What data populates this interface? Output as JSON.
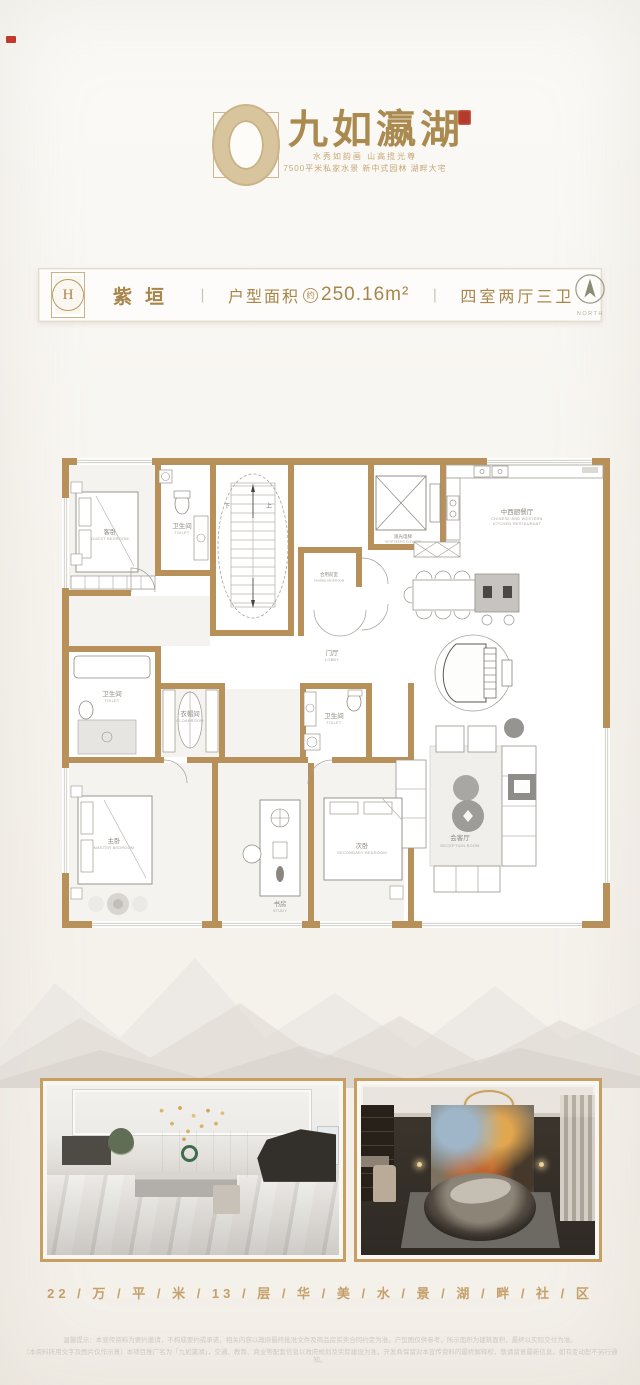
{
  "logo": {
    "brand_name": "九如瀛湖",
    "tagline_line1": "水秀如韵画 山高揽光尊",
    "tagline_line2": "7500平米私家水景 新中式园林 湖畔大宅"
  },
  "banner": {
    "emblem_letter": "H",
    "unit_name": "紫垣",
    "divider": "丨",
    "area_label": "户型面积",
    "area_circle": "约",
    "area_value": "250.16m²",
    "rooms_label": "四室两厅三卫",
    "compass_label": "NORTH"
  },
  "floorplan": {
    "stair_up": "上",
    "stair_down": "下",
    "rooms": {
      "guest_bedroom": {
        "cn": "客卧",
        "en": "GUEST BEDROOM"
      },
      "toilet_top": {
        "cn": "卫生间",
        "en": "TOILET"
      },
      "shared_anteroom": {
        "cn": "合用前室",
        "en": "SHARED ANTEROOM"
      },
      "elevator": {
        "cn": "观光电梯",
        "en": "SIGHTSEEING ELEVATOR"
      },
      "kitchen": {
        "cn": "中西厨餐厅",
        "en1": "CHINESE AND WESTERN",
        "en2": "KITCHEN RESTAURANT"
      },
      "lobby": {
        "cn": "门厅",
        "en": "LOBBY"
      },
      "toilet_left": {
        "cn": "卫生间",
        "en": "TOILET"
      },
      "cloakroom": {
        "cn": "衣帽间",
        "en": "CLOAKROOM"
      },
      "toilet_mid": {
        "cn": "卫生间",
        "en": "TOILET"
      },
      "master_bedroom": {
        "cn": "主卧",
        "en": "MASTER BEDROOM"
      },
      "study": {
        "cn": "书房",
        "en": "STUDY"
      },
      "secondary_bedroom": {
        "cn": "次卧",
        "en": "SECONDARY BEDROOM"
      },
      "reception": {
        "cn": "会客厅",
        "en": "RECEPTION ROOM"
      }
    }
  },
  "footer": {
    "tagline": "22 / 万 / 平 / 米 / 13 / 层 / 华 / 美 / 水 / 景 / 湖 / 畔 / 社 / 区",
    "disclaimer_line1": "温馨提示：本宣传资料为要约邀请，不构成要约或承诺，相关内容以政府最终批准文件及商品房买卖合同约定为准。户型图仅供参考，所示面积为建筑面积，最终以实际交付为准。",
    "disclaimer_line2": "（本资料所用文字及图片仅作示意）本项目推广名为「九如瀛湖」，交通、教育、商业等配套信息以政府规划及实际建设为准，开发商保留对本宣传资料的最终解释权，敬请留意最新信息，如有变动恕不另行通知。"
  },
  "colors": {
    "brand_gold": "#ab8a50",
    "wall_gold": "#b8905a",
    "seal_red": "#b43b2c",
    "footer_gold": "#c6a06a"
  }
}
